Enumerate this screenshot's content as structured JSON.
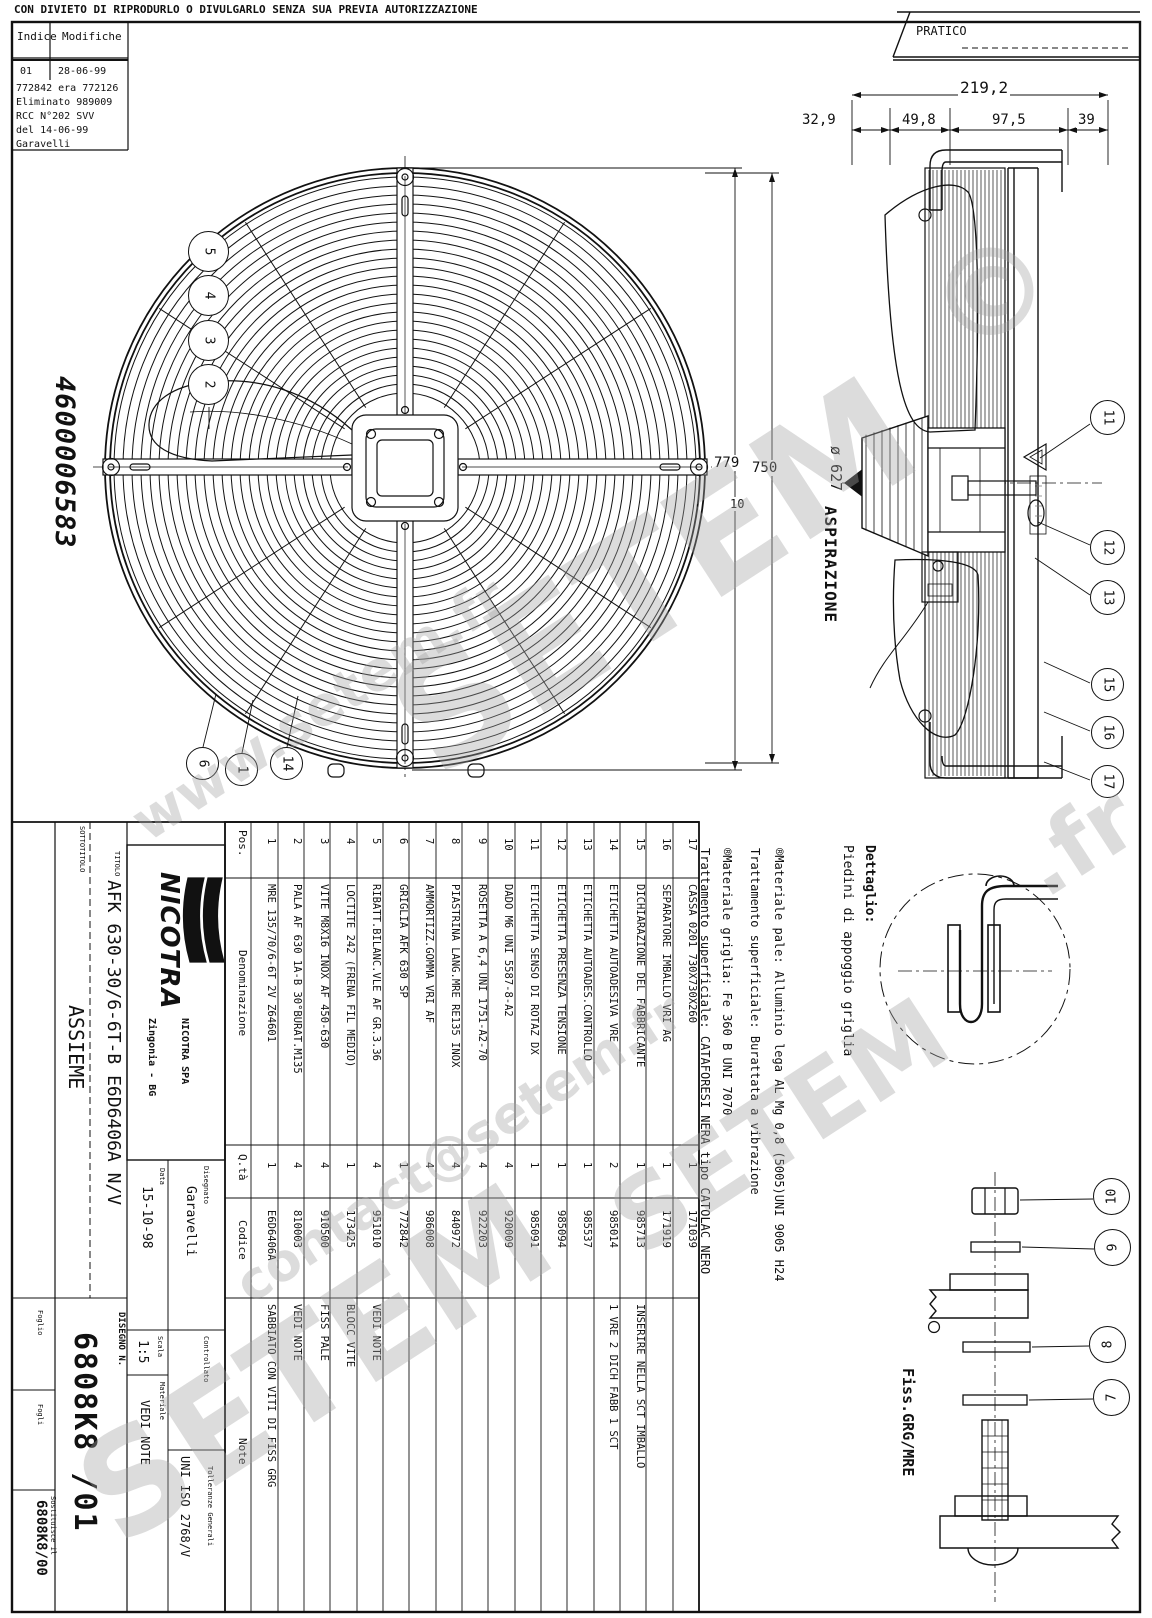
{
  "header": {
    "disclaimer": "CON DIVIETO DI RIPRODURLO O DIVULGARLO SENZA SUA PREVIA AUTORIZZAZIONE",
    "pratico": "PRATICO"
  },
  "revision_table": {
    "col_index": "Indice",
    "col_mods": "Modifiche",
    "row_index": "01",
    "row_date": "28-06-99",
    "lines": [
      "772842 era 772126",
      "Eliminato 989009",
      "RCC N°202    SVV",
      "del 14-06-99",
      "Garavelli"
    ]
  },
  "drawing_number_vertical": "4600006583",
  "dimensions": {
    "d_total": "219,2",
    "d_329": "32,9",
    "d_498": "49,8",
    "d_975": "97,5",
    "d_39": "39",
    "d_779": "779",
    "d_750": "750",
    "d_10": "10",
    "diameter": "ø 627",
    "airflow": "ASPIRAZIONE"
  },
  "detail_labels": {
    "dettaglio_line1": "Dettaglio:",
    "dettaglio_line2": "Piedini di appoggio griglia",
    "fiss": "Fiss.GRG/MRE"
  },
  "material_notes": [
    "®Materiale pale: Alluminio lega AL Mg 0,8 (5005)UNI 9005 H24",
    "Trattamento superficiale: Burattata a vibrazione",
    "®Materiale griglia: Fe 360 B  UNI 7070",
    "Trattamento superficiale: CATAFORESI NERA tipo CATOLAC NERO"
  ],
  "balloons": [
    {
      "id": "1",
      "label": "1",
      "rot": 90
    },
    {
      "id": "2",
      "label": "2",
      "rot": 90
    },
    {
      "id": "3",
      "label": "3",
      "rot": 90
    },
    {
      "id": "4",
      "label": "4",
      "rot": 90
    },
    {
      "id": "5",
      "label": "5",
      "rot": 90
    },
    {
      "id": "6",
      "label": "6",
      "rot": 90
    },
    {
      "id": "7",
      "label": "7",
      "rot": -90
    },
    {
      "id": "8",
      "label": "8",
      "rot": -90
    },
    {
      "id": "9",
      "label": "9",
      "rot": -90
    },
    {
      "id": "10",
      "label": "10",
      "rot": -90
    },
    {
      "id": "11",
      "label": "11",
      "rot": 90
    },
    {
      "id": "12",
      "label": "12",
      "rot": 90
    },
    {
      "id": "13",
      "label": "13",
      "rot": 90
    },
    {
      "id": "14",
      "label": "14",
      "rot": 90
    },
    {
      "id": "15",
      "label": "15",
      "rot": 90
    },
    {
      "id": "16",
      "label": "16",
      "rot": 90
    },
    {
      "id": "17",
      "label": "17",
      "rot": 90
    }
  ],
  "parts_table": {
    "headers": {
      "pos": "Pos.",
      "den": "Denominazione",
      "qty": "Q.tà",
      "code": "Codice",
      "note": "Note"
    },
    "parts": [
      {
        "pos": "1",
        "name": "MRE 135/70/6-6T 2V Z64601",
        "qty": "1",
        "code": "E6D6406A",
        "note": "SABBIATO CON VITI DI FISS GRG"
      },
      {
        "pos": "2",
        "name": "PALA AF 630 1A-B 30°BURAT.M135",
        "qty": "4",
        "code": "810003",
        "note": "VEDI NOTE"
      },
      {
        "pos": "3",
        "name": "VITE M8X16 INOX AF 450-630",
        "qty": "4",
        "code": "910500",
        "note": "FISS PALE"
      },
      {
        "pos": "4",
        "name": "LOCTITE 242 (FRENA FIL MEDIO)",
        "qty": "1",
        "code": "173425",
        "note": "BLOCC VITE"
      },
      {
        "pos": "5",
        "name": "RIBATT.BILANC.VLE AF GR.3.36",
        "qty": "4",
        "code": "951010",
        "note": "VEDI NOTE"
      },
      {
        "pos": "6",
        "name": "GRIGLIA AFK 630 SP",
        "qty": "1",
        "code": "772842",
        "note": ""
      },
      {
        "pos": "7",
        "name": "AMMORTIZZ.GOMMA VRI AF",
        "qty": "4",
        "code": "986008",
        "note": ""
      },
      {
        "pos": "8",
        "name": "PIASTRINA LANG.MRE RE135 INOX",
        "qty": "4",
        "code": "840972",
        "note": ""
      },
      {
        "pos": "9",
        "name": "ROSETTA A 6,4 UNI 1751-A2-70",
        "qty": "4",
        "code": "922203",
        "note": ""
      },
      {
        "pos": "10",
        "name": "DADO M6 UNI 5587-8-A2",
        "qty": "4",
        "code": "920009",
        "note": ""
      },
      {
        "pos": "11",
        "name": "ETICHETTA SENSO DI ROTAZ DX",
        "qty": "1",
        "code": "985091",
        "note": ""
      },
      {
        "pos": "12",
        "name": "ETICHETTA PRESENZA TENSIONE",
        "qty": "1",
        "code": "985094",
        "note": ""
      },
      {
        "pos": "13",
        "name": "ETICHETTA AUTOADES.CONTROLLO",
        "qty": "1",
        "code": "985537",
        "note": ""
      },
      {
        "pos": "14",
        "name": "ETICHETTA AUTOADESIVA VRE",
        "qty": "2",
        "code": "985014",
        "note": "1 VRE 2 DICH FABB 1 SCT"
      },
      {
        "pos": "15",
        "name": "DICHIARAZIONE DEL FABBRICANTE",
        "qty": "1",
        "code": "985713",
        "note": "INSERIRE NELLA SCT IMBALLO"
      },
      {
        "pos": "16",
        "name": "SEPARATORE IMBALLO VRI AG",
        "qty": "1",
        "code": "171919",
        "note": ""
      },
      {
        "pos": "17",
        "name": "CASSA 0201 730X730X260",
        "qty": "1",
        "code": "171039",
        "note": ""
      }
    ]
  },
  "title_block": {
    "company": "NICOTRA",
    "company_line1": "NICOTRA SPA",
    "company_line2": "Zingonia - BG",
    "titolo_label": "TITOLO",
    "titolo": "AFK 630-30/6-6T-B E6D6406A N/V",
    "sottotitolo_label": "SOTTOTITOLO",
    "sottotitolo": "ASSIEME",
    "data_label": "Data",
    "data": "15-10-98",
    "disegnato_label": "Disegnato",
    "disegnato": "Garavelli",
    "controllato_label": "Controllato",
    "scala_label": "Scala",
    "scala": "1:5",
    "materiale_label": "Materiale",
    "materiale": "VEDI NOTE",
    "tolleranze_label": "Tolleranze Generali",
    "tolleranze": "UNI ISO 2768/V",
    "disegno_label": "DISEGNO N.",
    "disegno": "6808K8 /01",
    "foglio_label": "Foglio",
    "fogli_label": "Fogli",
    "sostituisce_label": "Sostituisce il",
    "sostituisce": "6808K8/00"
  },
  "watermarks": [
    "SETEM",
    "www.setem.fr",
    "SETEM",
    "contact@setem.fr",
    "SETEM",
    "©",
    ".fr"
  ]
}
